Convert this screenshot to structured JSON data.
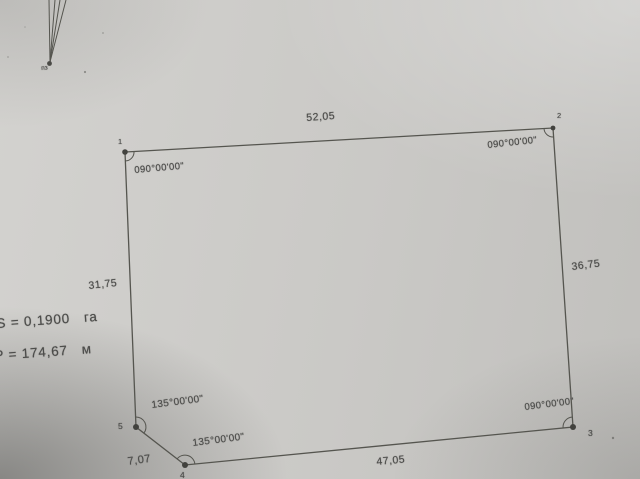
{
  "colors": {
    "paper": "#cac9c6",
    "ink": "#4c4c4a"
  },
  "plot": {
    "area": {
      "value": "S = 0,1900",
      "unit": "га"
    },
    "perimeter": {
      "value": "P = 174,67",
      "unit": "м"
    },
    "benchmark_label": "пз",
    "vertex_ids": [
      "1",
      "2",
      "3",
      "4",
      "5"
    ],
    "side_lengths": {
      "top": "52,05",
      "right": "36,75",
      "bottom": "47,05",
      "left": "31,75",
      "cut": "7,07"
    },
    "angles": {
      "v1": "090°00'00\"",
      "v2": "090°00'00\"",
      "v3": "090°00'00\"",
      "v4": "135°00'00\"",
      "v5": "135°00'00\""
    }
  }
}
